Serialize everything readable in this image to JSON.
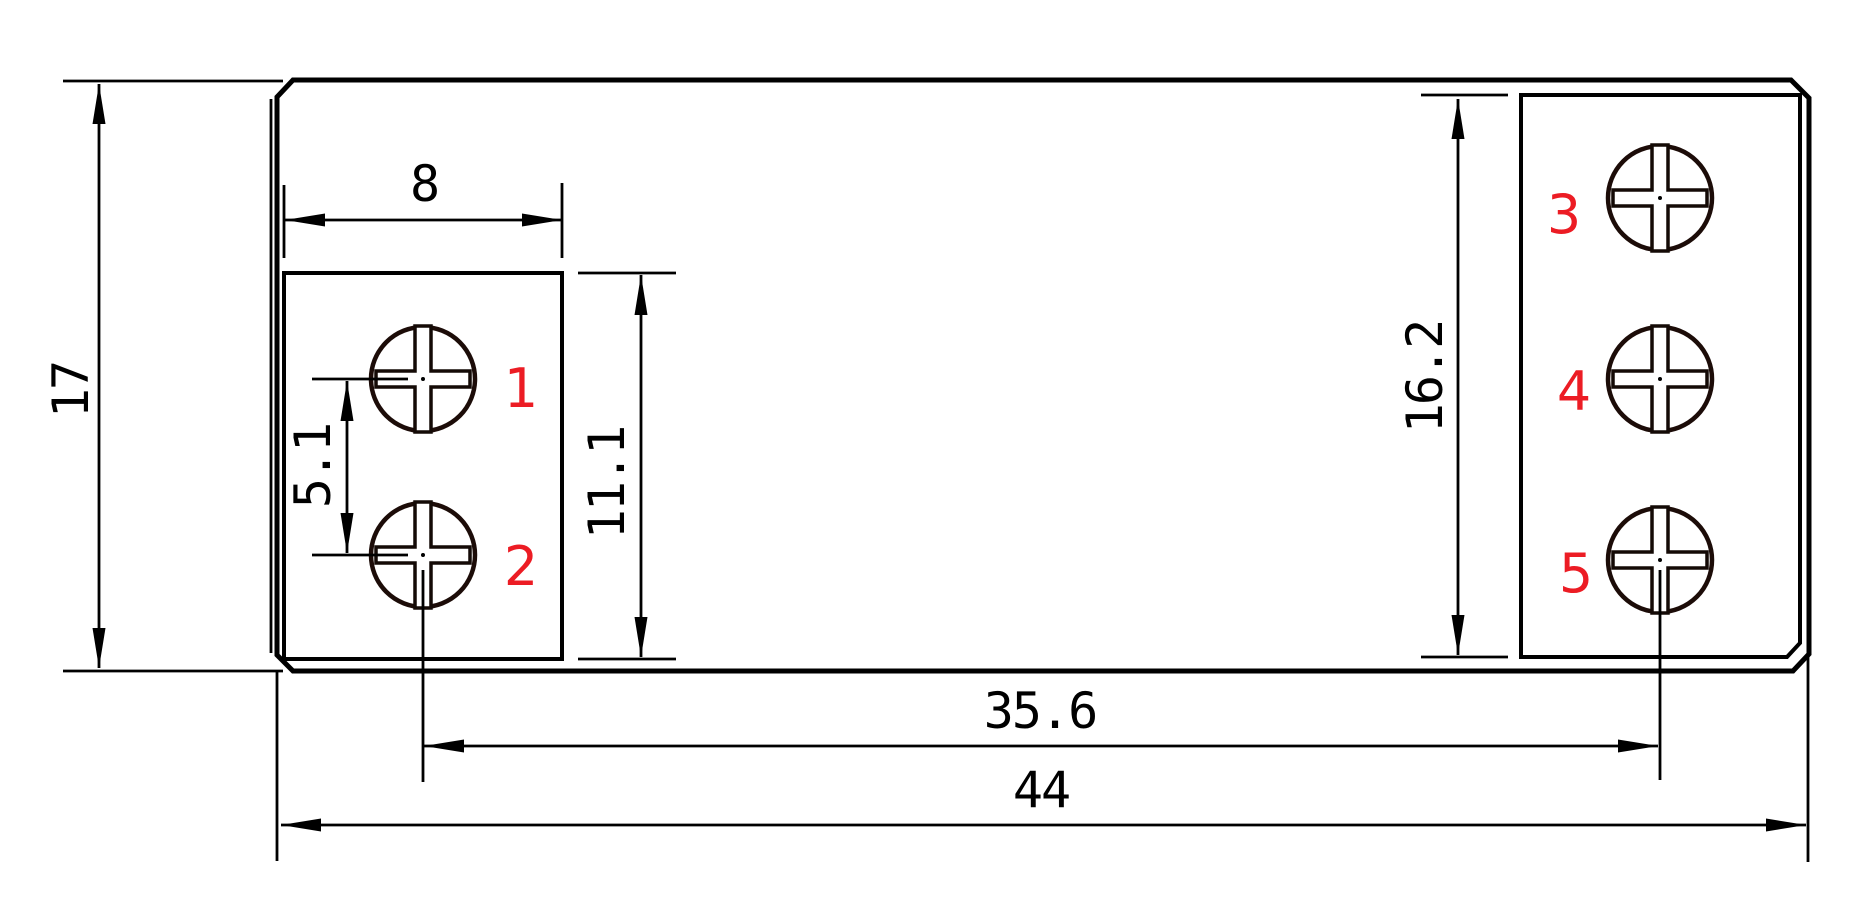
{
  "drawing": {
    "type": "technical-dimension-drawing",
    "background": "#ffffff",
    "line_color": "#000000",
    "accent_red": "#ec1c24",
    "units_scale_px_per_mm": 34.75,
    "dimensions": {
      "body_height": "17",
      "block_width": "8",
      "screw_pitch": "5.1",
      "left_block_height": "11.1",
      "right_block_height": "16.2",
      "screw_span": "35.6",
      "body_width": "44"
    },
    "terminal_labels": [
      "1",
      "2",
      "3",
      "4",
      "5"
    ]
  }
}
